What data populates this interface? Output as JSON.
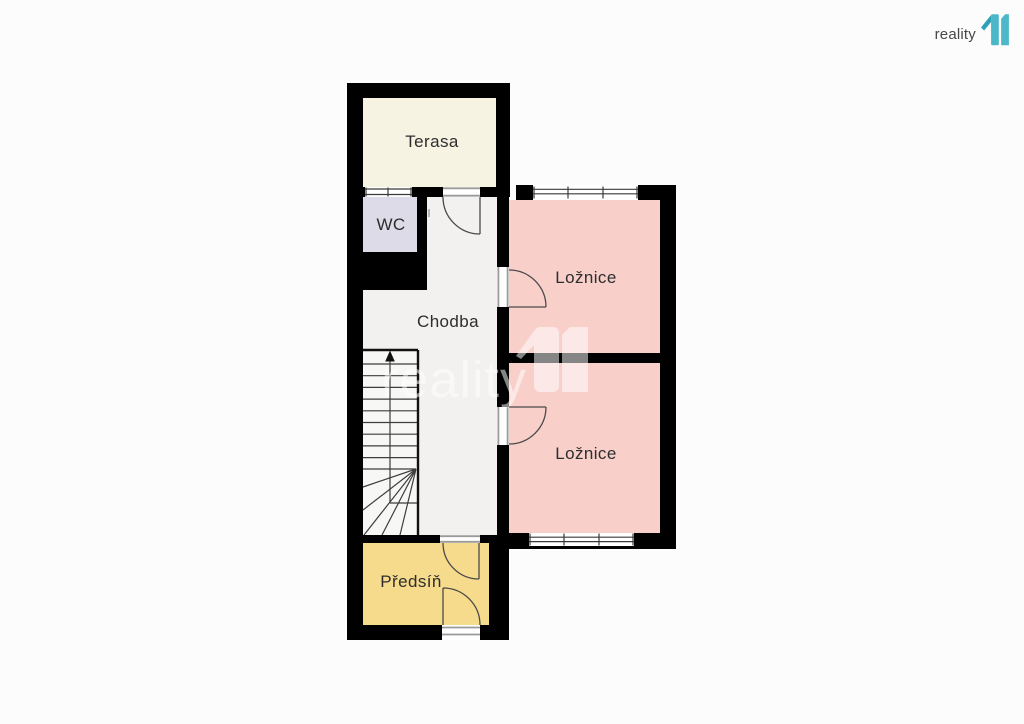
{
  "brand": {
    "name": "reality",
    "logo_digits": "11",
    "colors": {
      "logo_teal": "#4db7ca",
      "logo_flag": "#2ba2b8",
      "text": "#474747"
    }
  },
  "watermark": {
    "text": "reality",
    "logo_digits": "11"
  },
  "floorplan": {
    "wall_color": "#000000",
    "stairs_arrow": "up",
    "rooms": [
      {
        "name": "Terasa",
        "color": "#f6f3e3"
      },
      {
        "name": "WC",
        "color": "#dcdbe7"
      },
      {
        "name": "Chodba",
        "color": "#f2f1ef"
      },
      {
        "name": "Ložnice",
        "color": "#f9cfca"
      },
      {
        "name": "Ložnice",
        "color": "#f9cfca"
      },
      {
        "name": "Předsíň",
        "color": "#f6db8c"
      }
    ]
  }
}
